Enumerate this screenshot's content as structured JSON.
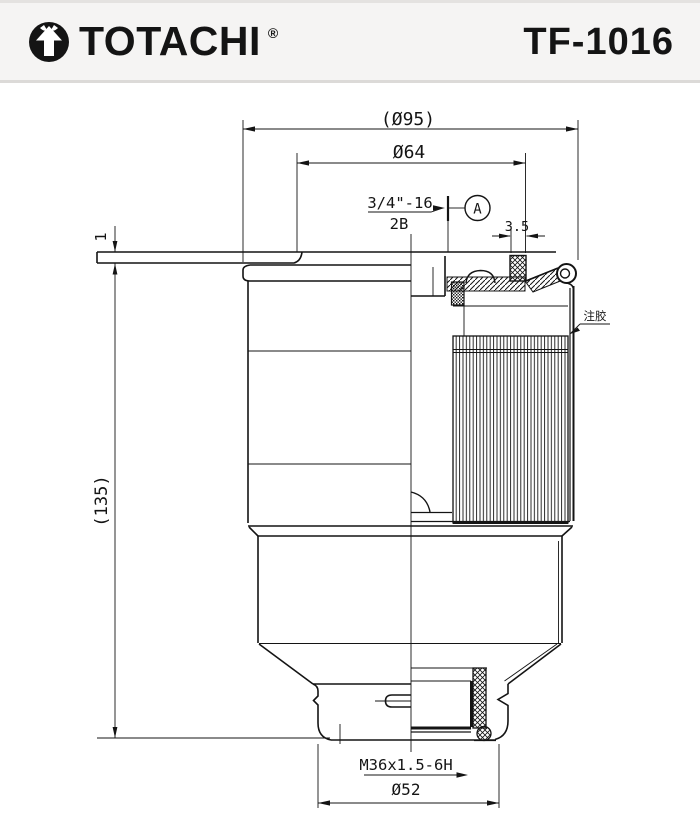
{
  "header": {
    "brand": "TOTACHI",
    "registered": "®",
    "part_number": "TF-1016"
  },
  "drawing": {
    "labels": {
      "dia_overall": "(Ø95)",
      "dia_lid": "Ø64",
      "thread_top": "3/4\"-16",
      "thread_class": "2B",
      "datum": "A",
      "seam_width": "3.5",
      "plate_thickness": "1",
      "height_overall": "(135)",
      "glue_note": "注胶",
      "thread_bottom": "M36x1.5-6H",
      "dia_bottom": "Ø52"
    },
    "colors": {
      "line": "#141414",
      "header_bg": "#f5f4f3",
      "divider": "#dcdad8",
      "page_bg": "#ffffff"
    }
  }
}
